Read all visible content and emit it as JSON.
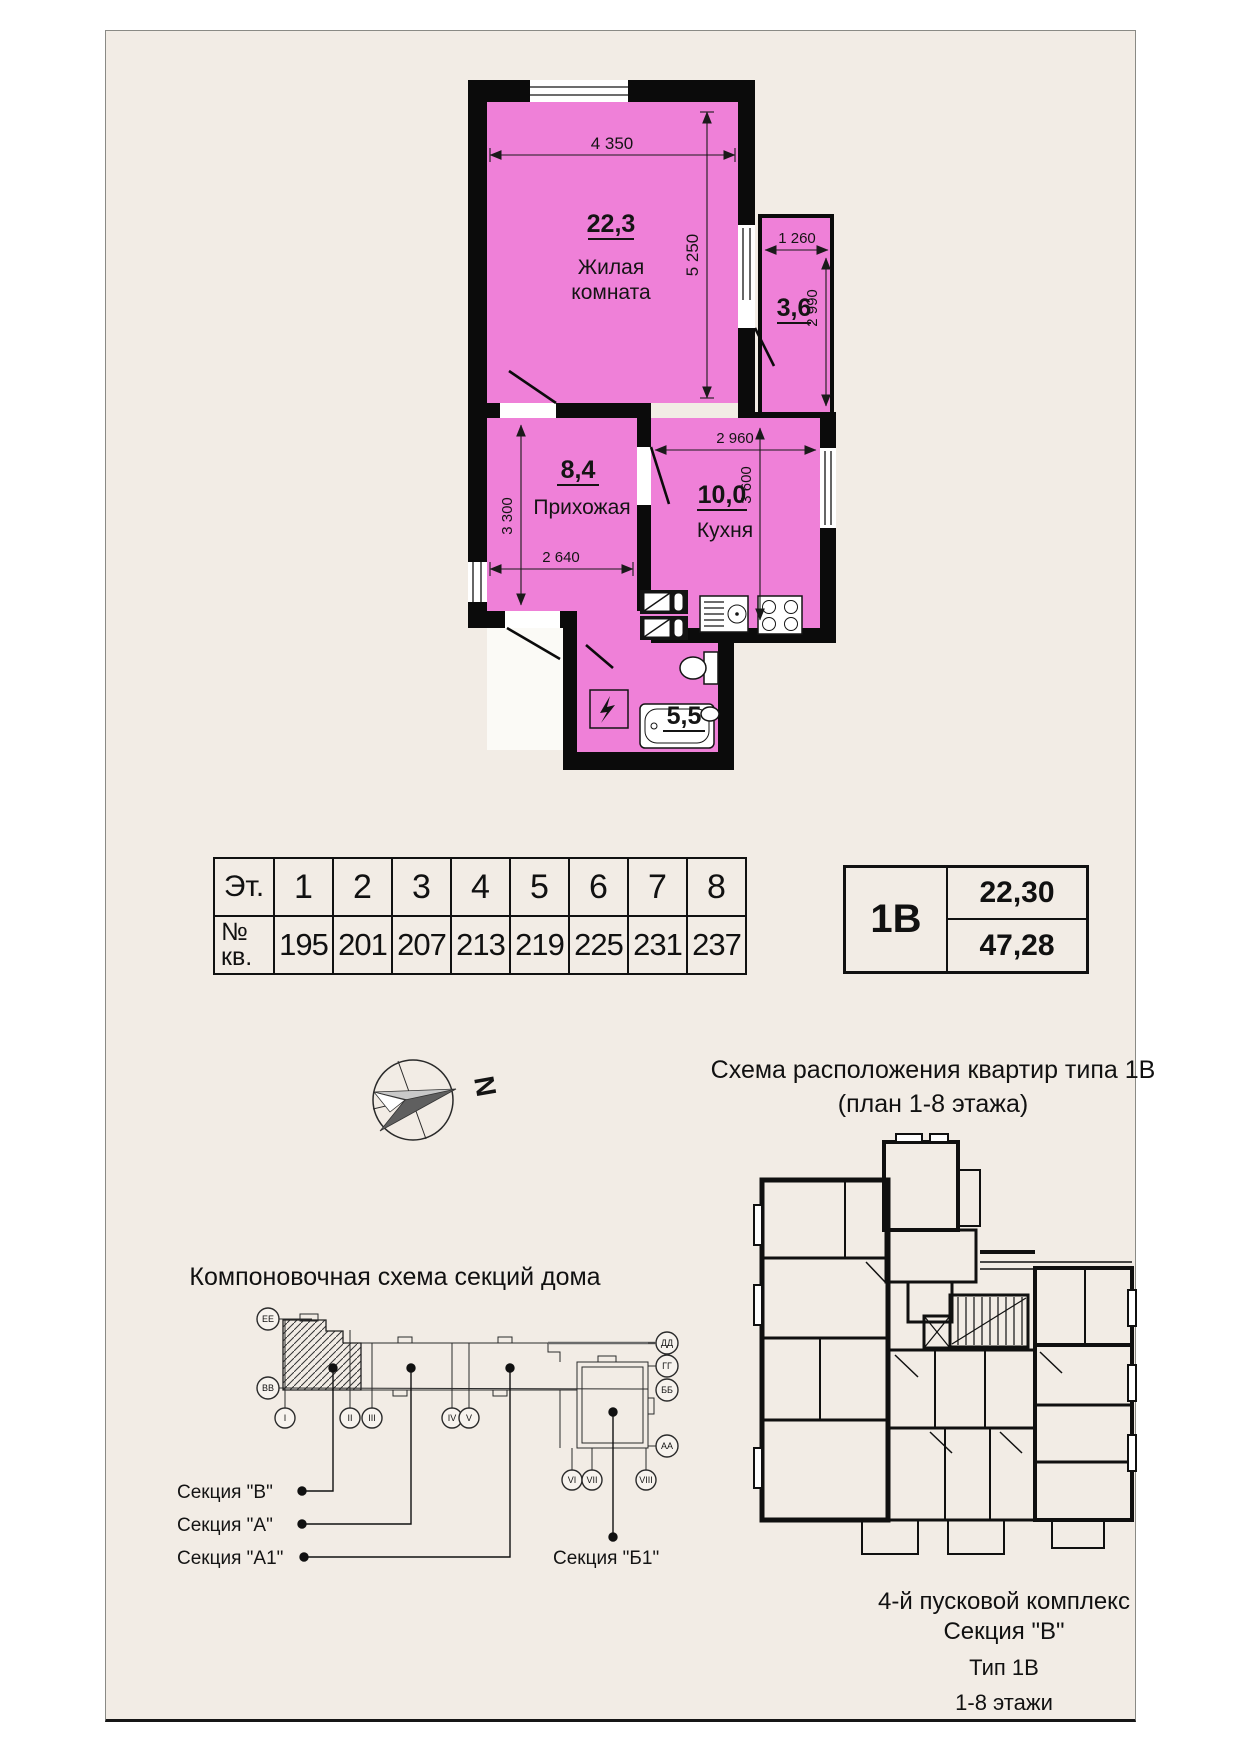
{
  "colors": {
    "room_fill": "#ef80d8",
    "wall": "#0b0b0b",
    "page_bg": "#f2ece5"
  },
  "plan": {
    "living": {
      "area": "22,3",
      "name_line1": "Жилая",
      "name_line2": "комната",
      "dim_width": "4 350",
      "dim_height": "5 250"
    },
    "balcony": {
      "area": "3,6",
      "dim_width": "1 260",
      "dim_height": "2 990"
    },
    "hall": {
      "area": "8,4",
      "name": "Прихожая",
      "dim_width": "2 640",
      "dim_height": "3 300"
    },
    "kitchen": {
      "area": "10,0",
      "name": "Кухня",
      "dim_width": "2 960",
      "dim_height": "3 600"
    },
    "bath": {
      "area": "5,5"
    }
  },
  "floors_table": {
    "floor_row_label": "Эт.",
    "apt_row_label_line1": "№",
    "apt_row_label_line2": "кв.",
    "floors": [
      "1",
      "2",
      "3",
      "4",
      "5",
      "6",
      "7",
      "8"
    ],
    "apartments": [
      "195",
      "201",
      "207",
      "213",
      "219",
      "225",
      "231",
      "237"
    ]
  },
  "type_box": {
    "type": "1В",
    "room_area": "22,30",
    "total_area": "47,28"
  },
  "compass": {
    "north_label": "N"
  },
  "location_scheme": {
    "title_line1": "Схема расположения квартир типа 1В",
    "title_line2": "(план 1-8 этажа)"
  },
  "section_scheme": {
    "title": "Компоновочная схема секций дома",
    "axis_labels": {
      "ee": "ЕЕ",
      "vv": "ВВ",
      "dd": "ДД",
      "gg": "ГГ",
      "bb": "ББ",
      "aa": "АА"
    },
    "column_labels": {
      "i": "I",
      "ii": "II",
      "iii": "III",
      "iv": "IV",
      "v": "V",
      "vi": "VI",
      "vii": "VII",
      "viii": "VIII"
    },
    "sections": {
      "v": "Секция \"В\"",
      "a": "Секция \"А\"",
      "a1": "Секция \"А1\"",
      "b1": "Секция \"Б1\""
    }
  },
  "footer": {
    "line1": "4-й пусковой комплекс",
    "line2": "Секция \"В\"",
    "line3": "Тип 1В",
    "line4": "1-8 этажи"
  }
}
